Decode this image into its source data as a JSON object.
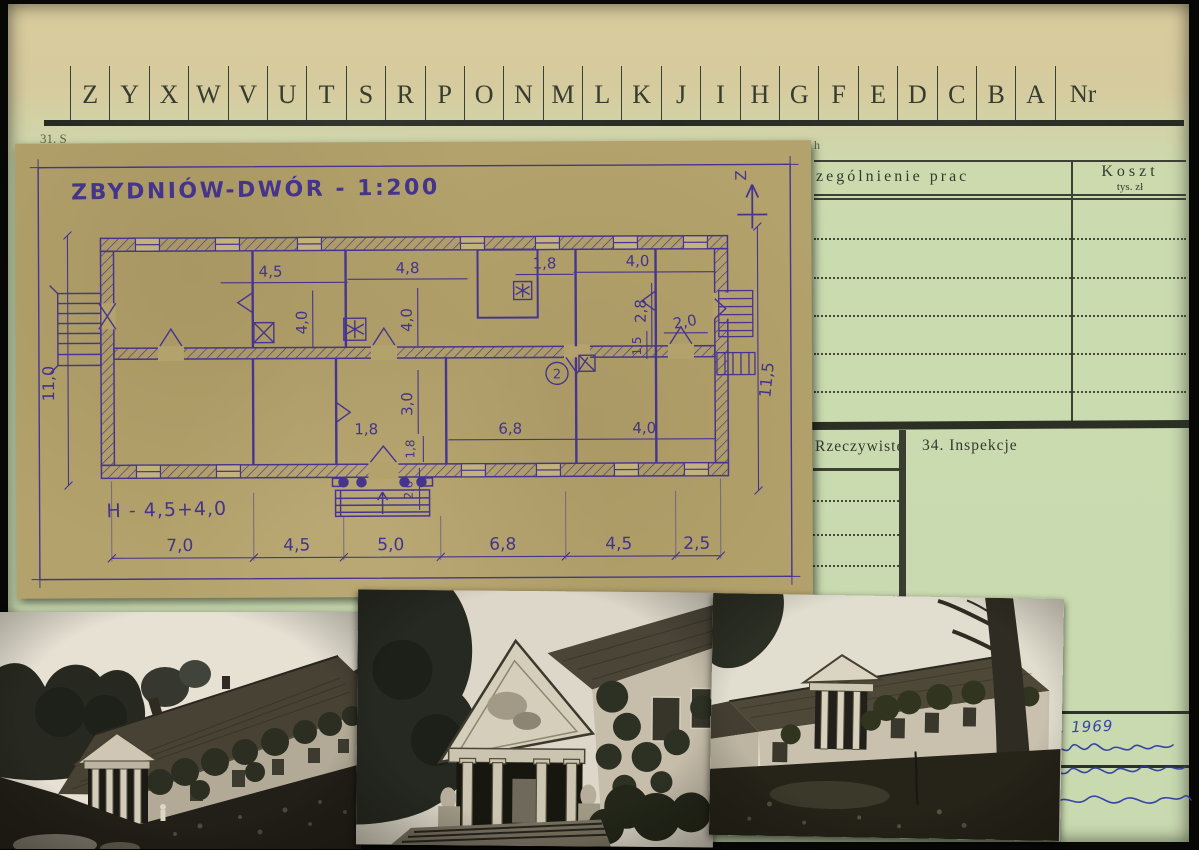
{
  "tabs": {
    "letters": [
      "Z",
      "Y",
      "X",
      "W",
      "V",
      "U",
      "T",
      "S",
      "R",
      "P",
      "O",
      "N",
      "M",
      "L",
      "K",
      "J",
      "I",
      "H",
      "G",
      "F",
      "E",
      "D",
      "C",
      "B",
      "A"
    ],
    "nr_label": "Nr"
  },
  "caption_fragments": {
    "left": "31. S",
    "right": "h"
  },
  "works_table": {
    "col_works_header": "zególnienie prac",
    "col_cost_header": "Koszt",
    "col_cost_unit": "tys. zł"
  },
  "status_table": {
    "col_actual_header": "Rzeczywiste",
    "col_inspections_header": "34. Inspekcje"
  },
  "sketch": {
    "title": "ZBYDNIÓW-DWÓR - 1:200",
    "north_label": "Z",
    "height_label": "H - 4,5+4,0",
    "room_note": "2",
    "dims": [
      "4,5",
      "4,8",
      "1,8",
      "4,0",
      "4,0",
      "4,0",
      "2,8",
      "1,5",
      "2,0",
      "3,0",
      "1,8",
      "1,8",
      "2,0",
      "6,8",
      "4,0",
      "7,0",
      "4,5",
      "5,0",
      "6,8",
      "4,5",
      "2,5",
      "11,0",
      "11,5"
    ]
  },
  "handwriting": {
    "date": "II. 1969"
  },
  "colors": {
    "card_green": "#c9dab0",
    "card_tan": "#d9cc9d",
    "sketch_paper": "#b4a26c",
    "ink_purple": "#46358e",
    "print_ink": "#343a2e",
    "note_blue": "#2b3aa0"
  }
}
